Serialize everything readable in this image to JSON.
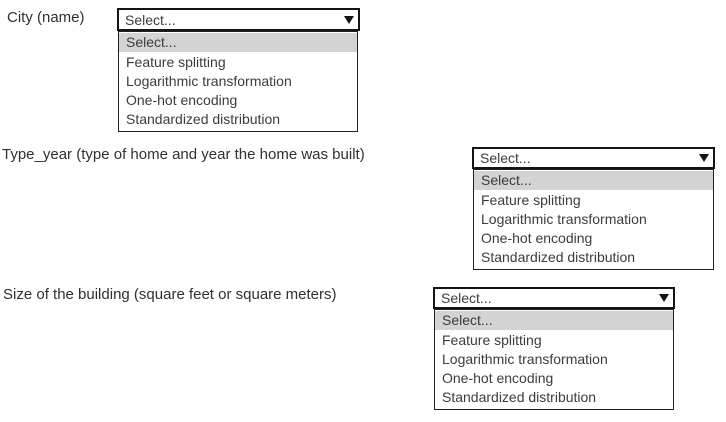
{
  "colors": {
    "background": "#ffffff",
    "select_border": "#141414",
    "list_border": "#1f1f1f",
    "option_highlight_bg": "#d3d3d3",
    "text": "#3c3c3c"
  },
  "dropdowns": [
    {
      "label": "City (name)",
      "selected": "Select...",
      "options": [
        "Select...",
        "Feature splitting",
        "Logarithmic transformation",
        "One-hot encoding",
        "Standardized distribution"
      ]
    },
    {
      "label": "Type_year (type of home and year the home was built)",
      "selected": "Select...",
      "options": [
        "Select...",
        "Feature splitting",
        "Logarithmic transformation",
        "One-hot encoding",
        "Standardized distribution"
      ]
    },
    {
      "label": "Size of the building (square feet or square meters)",
      "selected": "Select...",
      "options": [
        "Select...",
        "Feature splitting",
        "Logarithmic transformation",
        "One-hot encoding",
        "Standardized distribution"
      ]
    }
  ]
}
